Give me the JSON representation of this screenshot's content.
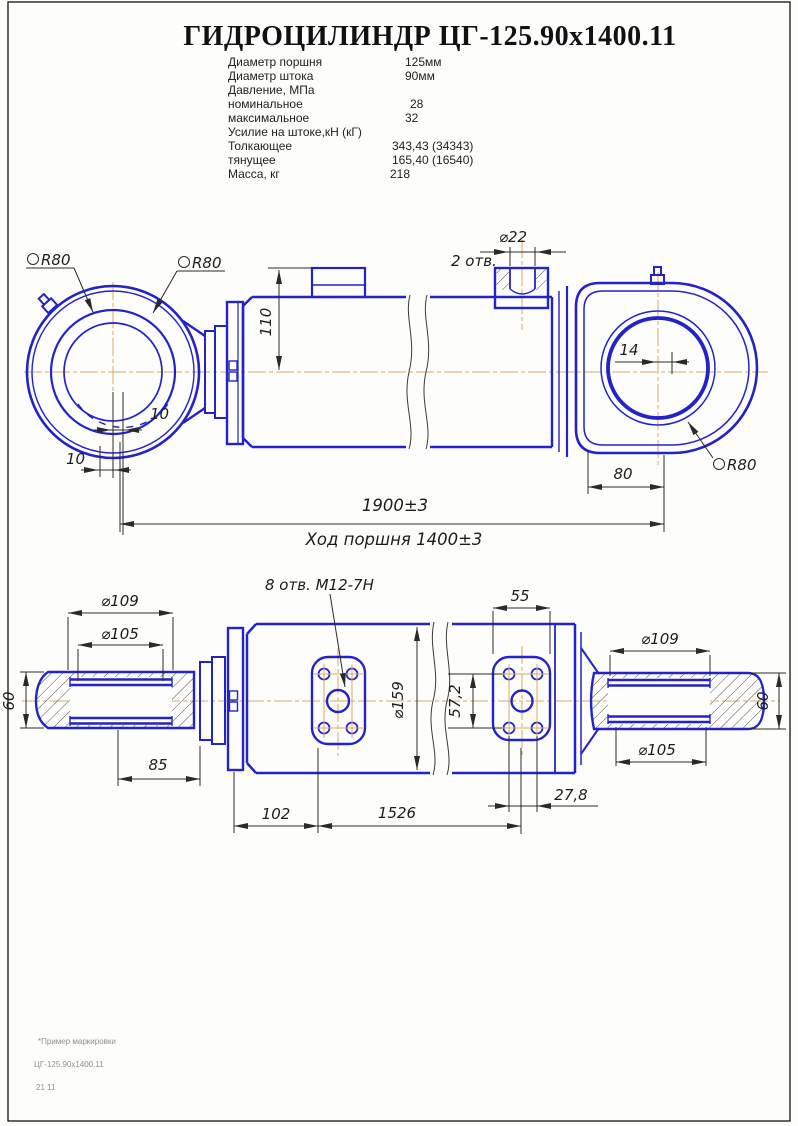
{
  "title": "ГИДРОЦИЛИНДР  ЦГ-125.90x1400.11",
  "specs": {
    "rows": [
      {
        "label": "Диаметр поршня",
        "value": "125мм"
      },
      {
        "label": "Диаметр штока",
        "value": "90мм"
      },
      {
        "label": "Давление, МПа",
        "value": ""
      },
      {
        "label": "номинальное",
        "value": "28"
      },
      {
        "label": "максимальное",
        "value": "32"
      },
      {
        "label": "Усилие на штоке,кН (кГ)",
        "value": ""
      },
      {
        "label": "Толкающее",
        "value": "343,43 (34343)"
      },
      {
        "label": "тянущее",
        "value": "165,40  (16540)"
      },
      {
        "label": "Масса,   кг",
        "value": "218"
      }
    ]
  },
  "side_view": {
    "r80": "R80",
    "dia22": "⌀22",
    "holes2": "2 отв.",
    "dim110": "110",
    "dim14": "14",
    "dim10": "10",
    "dim80": "80",
    "length": "1900±3",
    "stroke": "Ход поршня 1400±3"
  },
  "bottom_view": {
    "dia109": "⌀109",
    "dia105": "⌀105",
    "dim60": "60",
    "dim85": "85",
    "holes8": "8 отв. М12-7Н",
    "dia159": "⌀159",
    "dim57": "57,2",
    "dim55": "55",
    "dim102": "102",
    "dim1526": "1526",
    "dim278": "27,8"
  },
  "footer": {
    "note": "*Пример маркировки",
    "model": "ЦГ-125.90х1400.11",
    "code": "21  11"
  },
  "colors": {
    "line_blue": "#2323c8",
    "dim_black": "#2a2a2a",
    "centerline_tan": "#d8ab66",
    "footer_gray": "#8f8f8f"
  }
}
